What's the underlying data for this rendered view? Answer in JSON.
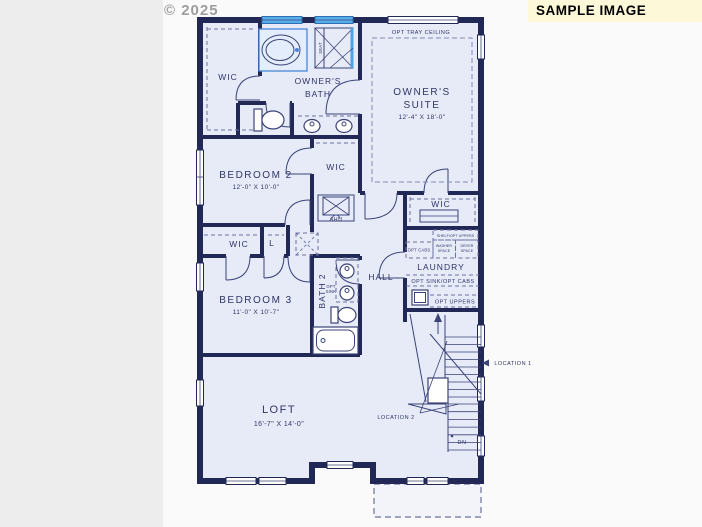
{
  "watermark": {
    "text": "© 2025"
  },
  "banner": {
    "text": "SAMPLE IMAGE"
  },
  "rooms": {
    "owners_wic": "WIC",
    "owners_bath_1": "OWNER'S",
    "owners_bath_2": "BATH",
    "opt_tray_ceiling": "OPT TRAY CEILING",
    "owners_suite_1": "OWNER'S",
    "owners_suite_2": "SUITE",
    "owners_suite_dims": "12'-4\" X 18'-0\"",
    "bedroom2": "BEDROOM 2",
    "bedroom2_dims": "12'-0\" X 10'-0\"",
    "bedroom2_wic": "WIC",
    "owners_wic2": "WIC",
    "ahu": "AHU",
    "laundry": "LAUNDRY",
    "bath2": "BATH 2",
    "hall": "HALL",
    "closet_wic": "WIC",
    "closet_linen": "L",
    "bedroom3": "BEDROOM 3",
    "bedroom3_dims": "11'-0\" X 10'-7\"",
    "loft": "LOFT",
    "loft_dims": "16'-7\" X 14'-0\""
  },
  "annotations": {
    "seat": "SEAT",
    "shelf_opt_uppers": "SHELF/OPT UPPERS",
    "opt_cabs": "OPT CABS",
    "washer_1": "WASHER",
    "washer_2": "SPACE",
    "dryer_1": "DRYER",
    "dryer_2": "SPACE",
    "opt_sink_opt_cabs": "OPT SINK/OPT CABS",
    "opt_uppers": "OPT UPPERS",
    "opt_sink_1": "OPT",
    "opt_sink_2": "SINK",
    "location1": "LOCATION 1",
    "location2": "LOCATION 2",
    "dn": "DN"
  },
  "colors": {
    "wall": "#222856",
    "floor": "#e7ebf8",
    "line": "#3b4377",
    "text": "#2f3568",
    "dash": "#6a71a0",
    "fixture_blue": "#49a5e6",
    "window_blue": "#58aeec",
    "tub_blue": "#4a86d8",
    "banner_bg": "#fdf8d7",
    "banner_text": "#000000",
    "watermark": "#9e9e9e",
    "page_bg": "#fafafa",
    "left_band": "#ededee"
  }
}
